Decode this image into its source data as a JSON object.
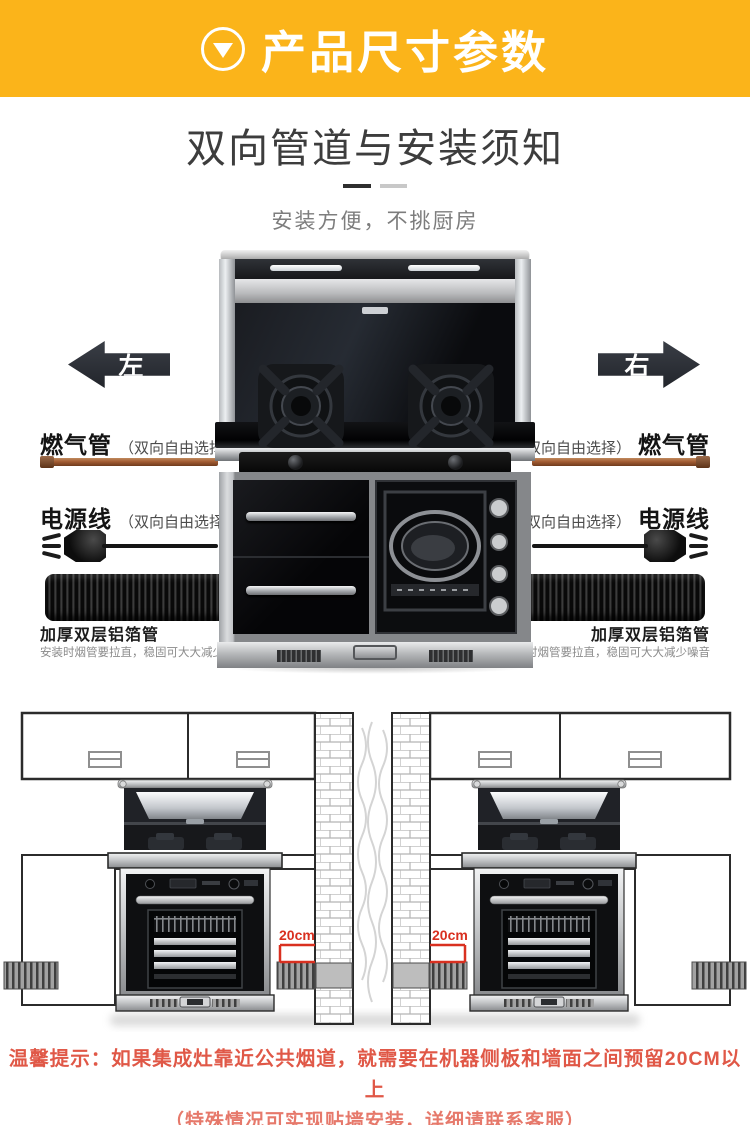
{
  "banner": {
    "title": "产品尺寸参数",
    "icon": "circle-down-triangle-icon",
    "bg_color": "#fbb41a",
    "text_color": "#ffffff"
  },
  "intro": {
    "title": "双向管道与安装须知",
    "subtitle": "安装方便，不挑厨房"
  },
  "arrows": {
    "left_label": "左",
    "right_label": "右"
  },
  "gas": {
    "left_title": "燃气管",
    "left_note": "（双向自由选择）",
    "right_note": "（双向自由选择）",
    "right_title": "燃气管",
    "pipe_color": "#a35c33"
  },
  "power": {
    "left_title": "电源线",
    "left_note": "（双向自由选择）",
    "right_note": "（双向自由选择）",
    "right_title": "电源线"
  },
  "foil": {
    "left_title": "加厚双层铝箔管",
    "left_note": "安装时烟管要拉直，稳固可大大减少噪音",
    "right_title": "加厚双层铝箔管",
    "right_note": "安装时烟管要拉直，稳固可大大减少噪音"
  },
  "diagram": {
    "clearance_left": "20cm",
    "clearance_right": "20cm",
    "accent_color": "#d93020"
  },
  "warning": {
    "line1": "温馨提示：如果集成灶靠近公共烟道，就需要在机器侧板和墙面之间预留20CM以上",
    "line2": "（特殊情况可实现贴墙安装，详细请联系客服）",
    "color": "#e05847"
  }
}
